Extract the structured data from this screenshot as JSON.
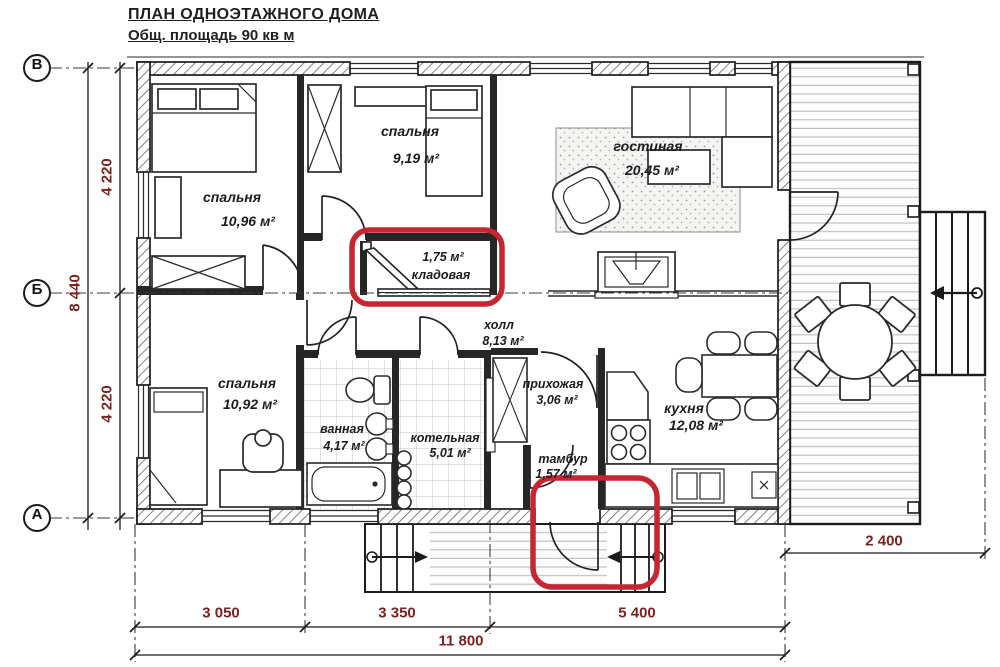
{
  "title": "ПЛАН ОДНОЭТАЖНОГО ДОМА",
  "subtitle": "Общ. площадь 90 кв м",
  "axis_labels": {
    "v": "В",
    "b": "Б",
    "a": "А"
  },
  "rooms": {
    "bedroom1": {
      "name": "спальня",
      "area": "10,96 м²"
    },
    "bedroom2": {
      "name": "спальня",
      "area": "9,19 м²"
    },
    "living_room": {
      "name": "гостиная",
      "area": "20,45 м²"
    },
    "storage": {
      "name": "кладовая",
      "area": "1,75 м²"
    },
    "hall": {
      "name": "холл",
      "area": "8,13 м²"
    },
    "bedroom3": {
      "name": "спальня",
      "area": "10,92 м²"
    },
    "bathroom": {
      "name": "ванная",
      "area": "4,17 м²"
    },
    "boiler_room": {
      "name": "котельная",
      "area": "5,01 м²"
    },
    "entry_hall": {
      "name": "прихожая",
      "area": "3,06 м²"
    },
    "vestibule": {
      "name": "тамбур",
      "area": "1,57 м²"
    },
    "kitchen": {
      "name": "кухня",
      "area": "12,08 м²"
    }
  },
  "dimensions": {
    "left_top": "4 220",
    "left_total": "8 440",
    "left_bottom": "4 220",
    "bottom_seg1": "3 050",
    "bottom_seg2": "3 350",
    "bottom_seg3": "5 400",
    "bottom_total": "11 800",
    "terrace_width": "2 400"
  },
  "colors": {
    "line": "#1b1b1b",
    "dimension_text": "#7b2320",
    "annotation_red": "#c52632"
  }
}
